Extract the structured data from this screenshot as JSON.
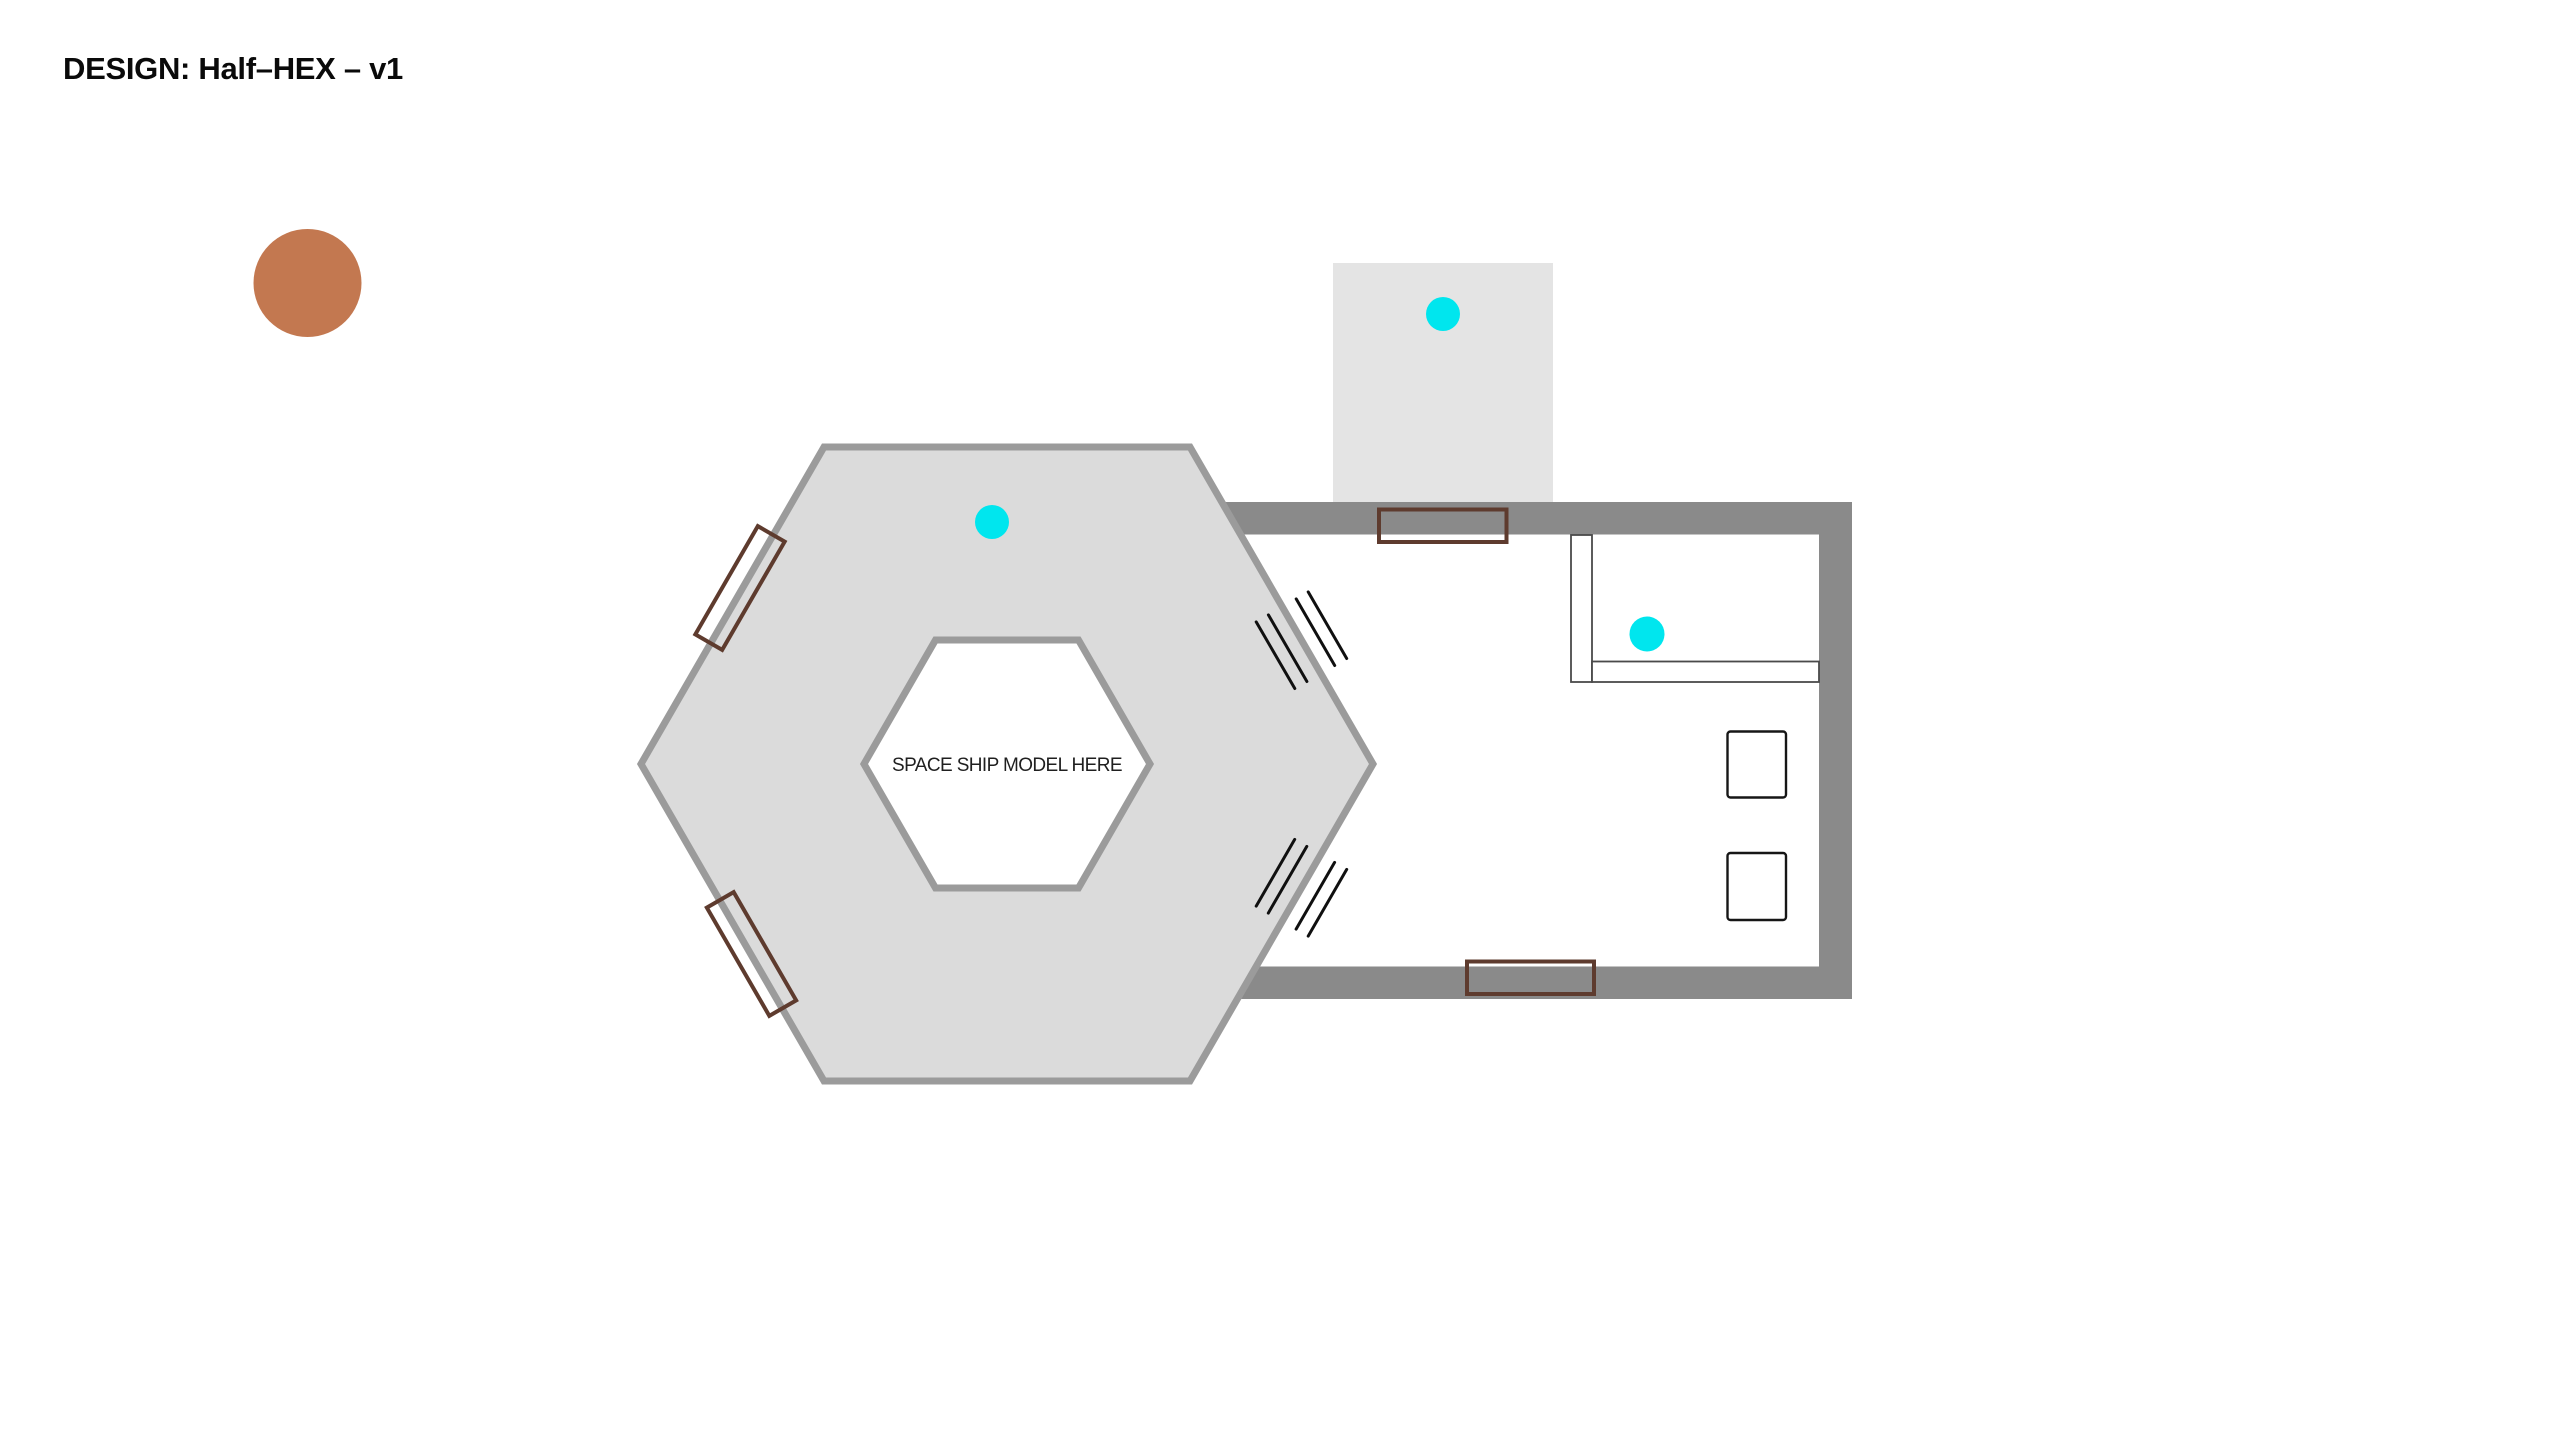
{
  "title": {
    "text": "DESIGN: Half–HEX – v1"
  },
  "hexagon": {
    "label": "SPACE SHIP MODEL HERE"
  },
  "colors": {
    "bg": "#FFFFFF",
    "wall": "#8A8A8A",
    "hex_fill": "#DBDBDB",
    "hex_stroke": "#9B9B9B",
    "vestibule_fill": "#E4E4E4",
    "door_brown": "#5E3B2E",
    "marker_cyan": "#00E6EE",
    "marker_orange": "#C37850",
    "hatch": "#101010",
    "furniture_stroke": "#161616",
    "counter_stroke": "#4A4A4A",
    "title_color": "#0A0A0A",
    "label_color": "#1F1F1F"
  },
  "markers": {
    "cyan_dot": "ceiling-light-marker",
    "orange_dot": "material-swatch"
  }
}
